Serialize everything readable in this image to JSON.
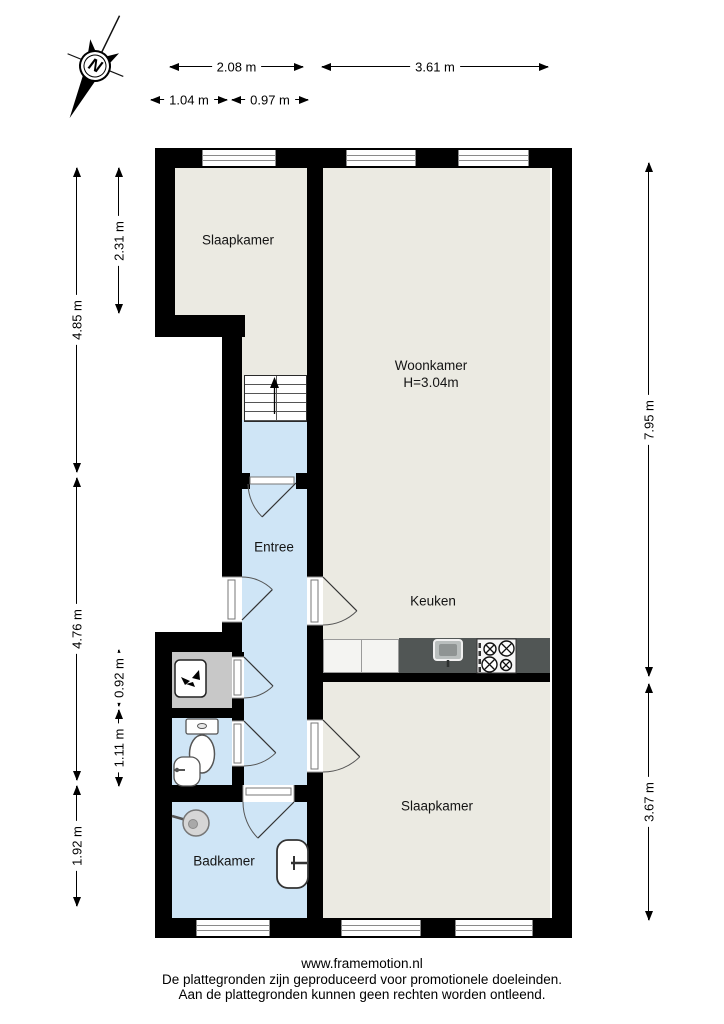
{
  "compass": {
    "label": "N"
  },
  "rooms": {
    "slaapkamer_top": {
      "label": "Slaapkamer"
    },
    "woonkamer": {
      "label": "Woonkamer",
      "height": "H=3.04m"
    },
    "entree": {
      "label": "Entree"
    },
    "keuken": {
      "label": "Keuken"
    },
    "slaapkamer_bottom": {
      "label": "Slaapkamer"
    },
    "badkamer": {
      "label": "Badkamer"
    }
  },
  "dimensions": {
    "top_width_left": "2.08 m",
    "top_width_right": "3.61 m",
    "top_sub_left": "1.04 m",
    "top_sub_right": "0.97 m",
    "left_upper": "4.85 m",
    "left_middle": "4.76 m",
    "left_lower": "1.92 m",
    "inner_upper": "2.31 m",
    "inner_closet": "0.92 m",
    "inner_toilet": "1.11 m",
    "right_upper": "7.95 m",
    "right_lower": "3.67 m"
  },
  "footer": {
    "website": "www.framemotion.nl",
    "disclaimer1": "De plattegronden zijn geproduceerd voor promotionele doeleinden.",
    "disclaimer2": "Aan de plattegronden kunnen geen rechten worden ontleend."
  },
  "colors": {
    "wall": "#000000",
    "room_floor": "#ebeae2",
    "wet_room_floor": "#cfe5f6",
    "closet_floor": "#c8c8c8",
    "kitchen_counter": "#515655"
  }
}
